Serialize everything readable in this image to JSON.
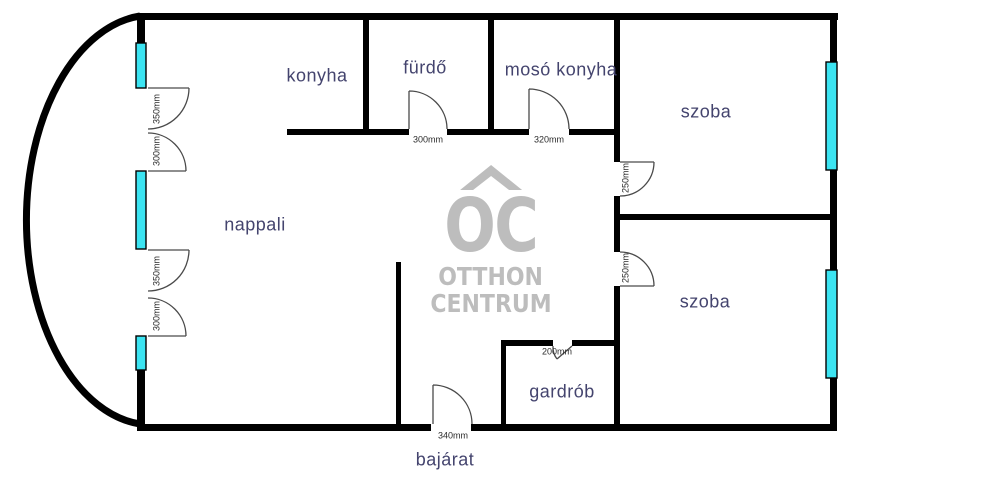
{
  "colors": {
    "bg": "#ffffff",
    "wall": "#000000",
    "window-fill": "#3be4f2",
    "window-border": "#000000",
    "door": "#4a4a4a",
    "label": "#44446e",
    "dim": "#2b2b2b",
    "watermark": "#bdbdbd"
  },
  "watermark": {
    "initials": "OC",
    "line1": "OTTHON",
    "line2": "CENTRUM"
  },
  "rooms": {
    "konyha": "konyha",
    "furdo": "fürdő",
    "moso_konyha": "mosó konyha",
    "szoba_top": "szoba",
    "szoba_bottom": "szoba",
    "nappali": "nappali",
    "gardrob": "gardrób",
    "bejarat": "bajárat"
  },
  "dimensions": {
    "balcony_door_top_a": "350mm",
    "balcony_door_top_b": "300mm",
    "balcony_door_bottom_a": "350mm",
    "balcony_door_bottom_b": "300mm",
    "furdo_door": "300mm",
    "moso_door": "320mm",
    "szoba_top_door": "250mm",
    "szoba_bottom_door": "250mm",
    "gardrob_door": "200mm",
    "entrance_door": "340mm"
  }
}
